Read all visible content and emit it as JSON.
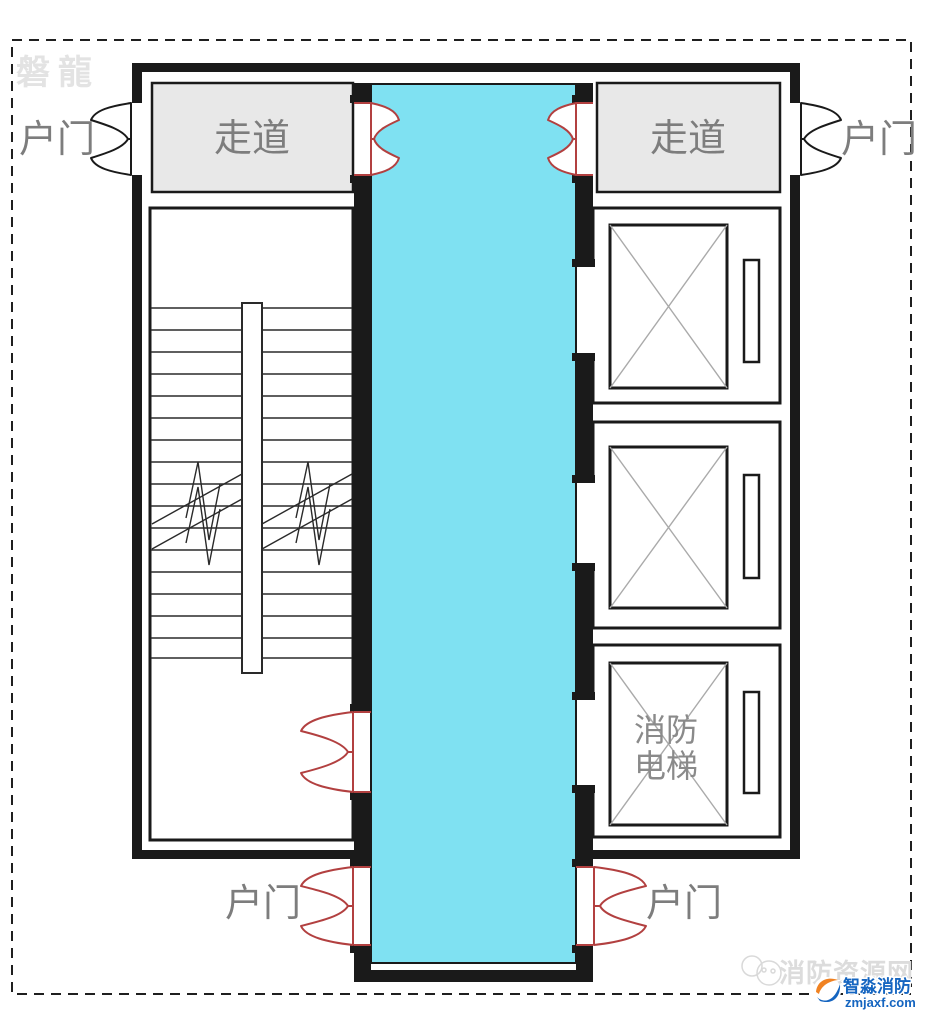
{
  "colors": {
    "wall": "#1a1a1a",
    "corridor_fill": "#7fe1f2",
    "hallway_fill": "#e8e8e8",
    "door_red": "#b24040",
    "label_gray": "#7d7d7d",
    "elevator_label_gray": "#8a8a8a",
    "watermark_gray": "#e3e3e3",
    "site_watermark_gray": "#dcdcdc",
    "logo_blue": "#1565c0",
    "logo_orange": "#f08222",
    "cab_x_gray": "#aaaaaa"
  },
  "watermarks": {
    "top_left": "磐龍",
    "site_name": "消防资源网",
    "logo_name": "智淼消防",
    "logo_domain": "zmjaxf.com"
  },
  "labels": {
    "unit_door": "户门",
    "corridor": "走道",
    "fire_elevator_line1": "消防",
    "fire_elevator_line2": "电梯"
  }
}
